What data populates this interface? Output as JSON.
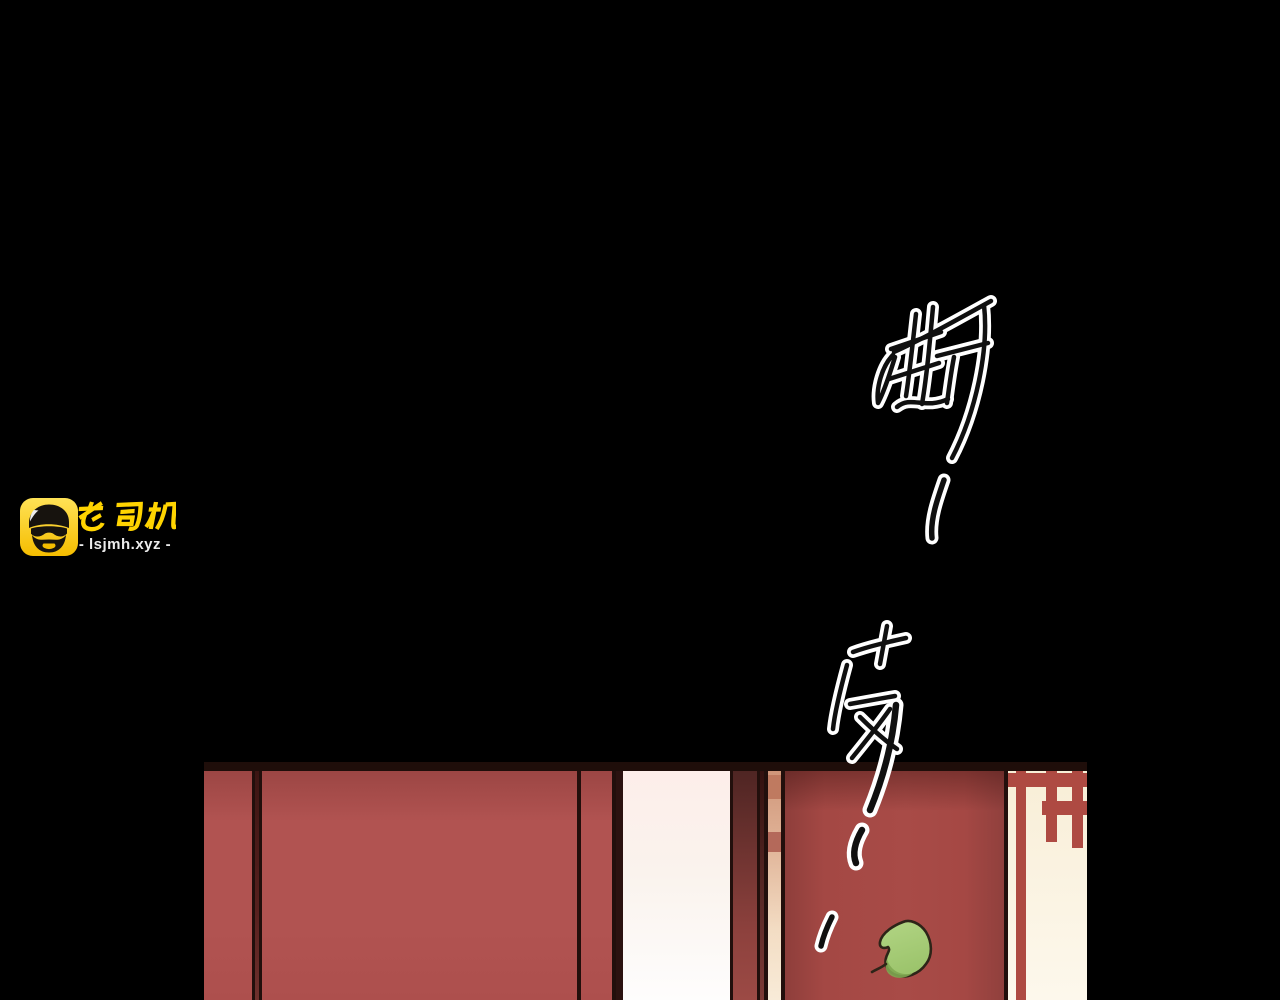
{
  "page": {
    "width": 1280,
    "height": 1000,
    "background": "#000000"
  },
  "watermark": {
    "brand_text": "老司机",
    "site_text": "- lsjmh.xyz -",
    "icon_name": "driver-avatar-icon",
    "colors": {
      "badge_top": "#ffe256",
      "badge_bottom": "#f5bd00",
      "ink": "#17130e",
      "brand_yellow": "#ffd400",
      "site_gray": "#ececec",
      "highlight": "#ffffff"
    }
  },
  "sfx": {
    "char_top": "嘶",
    "char_bottom": "吱",
    "trailing_dash_count": 3,
    "style": "hand-drawn calligraphic strokes, dark core with white outline",
    "colors": {
      "outline": "#ffffff",
      "ink": "#101010"
    }
  },
  "panel": {
    "scene": "Red lacquered doors slightly ajar; pale light through the doorway gap; carved lattice window on the right; a green leaf falling past the door.",
    "colors": {
      "top_border": "#1f0e0a",
      "line_dark": "#220f0c",
      "wall_red_top": "#9c4644",
      "wall_red": "#b15351",
      "wall_sliver": "#57201e",
      "door_red_left": "#8e3e3b",
      "door_red": "#a84b47",
      "door_red_right": "#90403d",
      "maroon_edge_top": "#4f2523",
      "maroon_edge_bottom": "#9c4a45",
      "cream_top": "#fdeeea",
      "cream_mid": "#faf3ed",
      "cream_bottom": "#fefdfd",
      "salmon_top": "#cf9579",
      "salmon_bottom": "#f8ebd8",
      "salmon_block": "#bf7a60",
      "salmon_block_2": "#b4695a",
      "lattice_bg_top": "#f8eed6",
      "lattice_bg_bottom": "#fdf8ec",
      "lattice_red": "#ae4a42",
      "leaf_green": "#9cc46c",
      "leaf_light": "#b2d584",
      "leaf_shadow": "#7fa751",
      "leaf_outline": "#2d2418"
    }
  }
}
